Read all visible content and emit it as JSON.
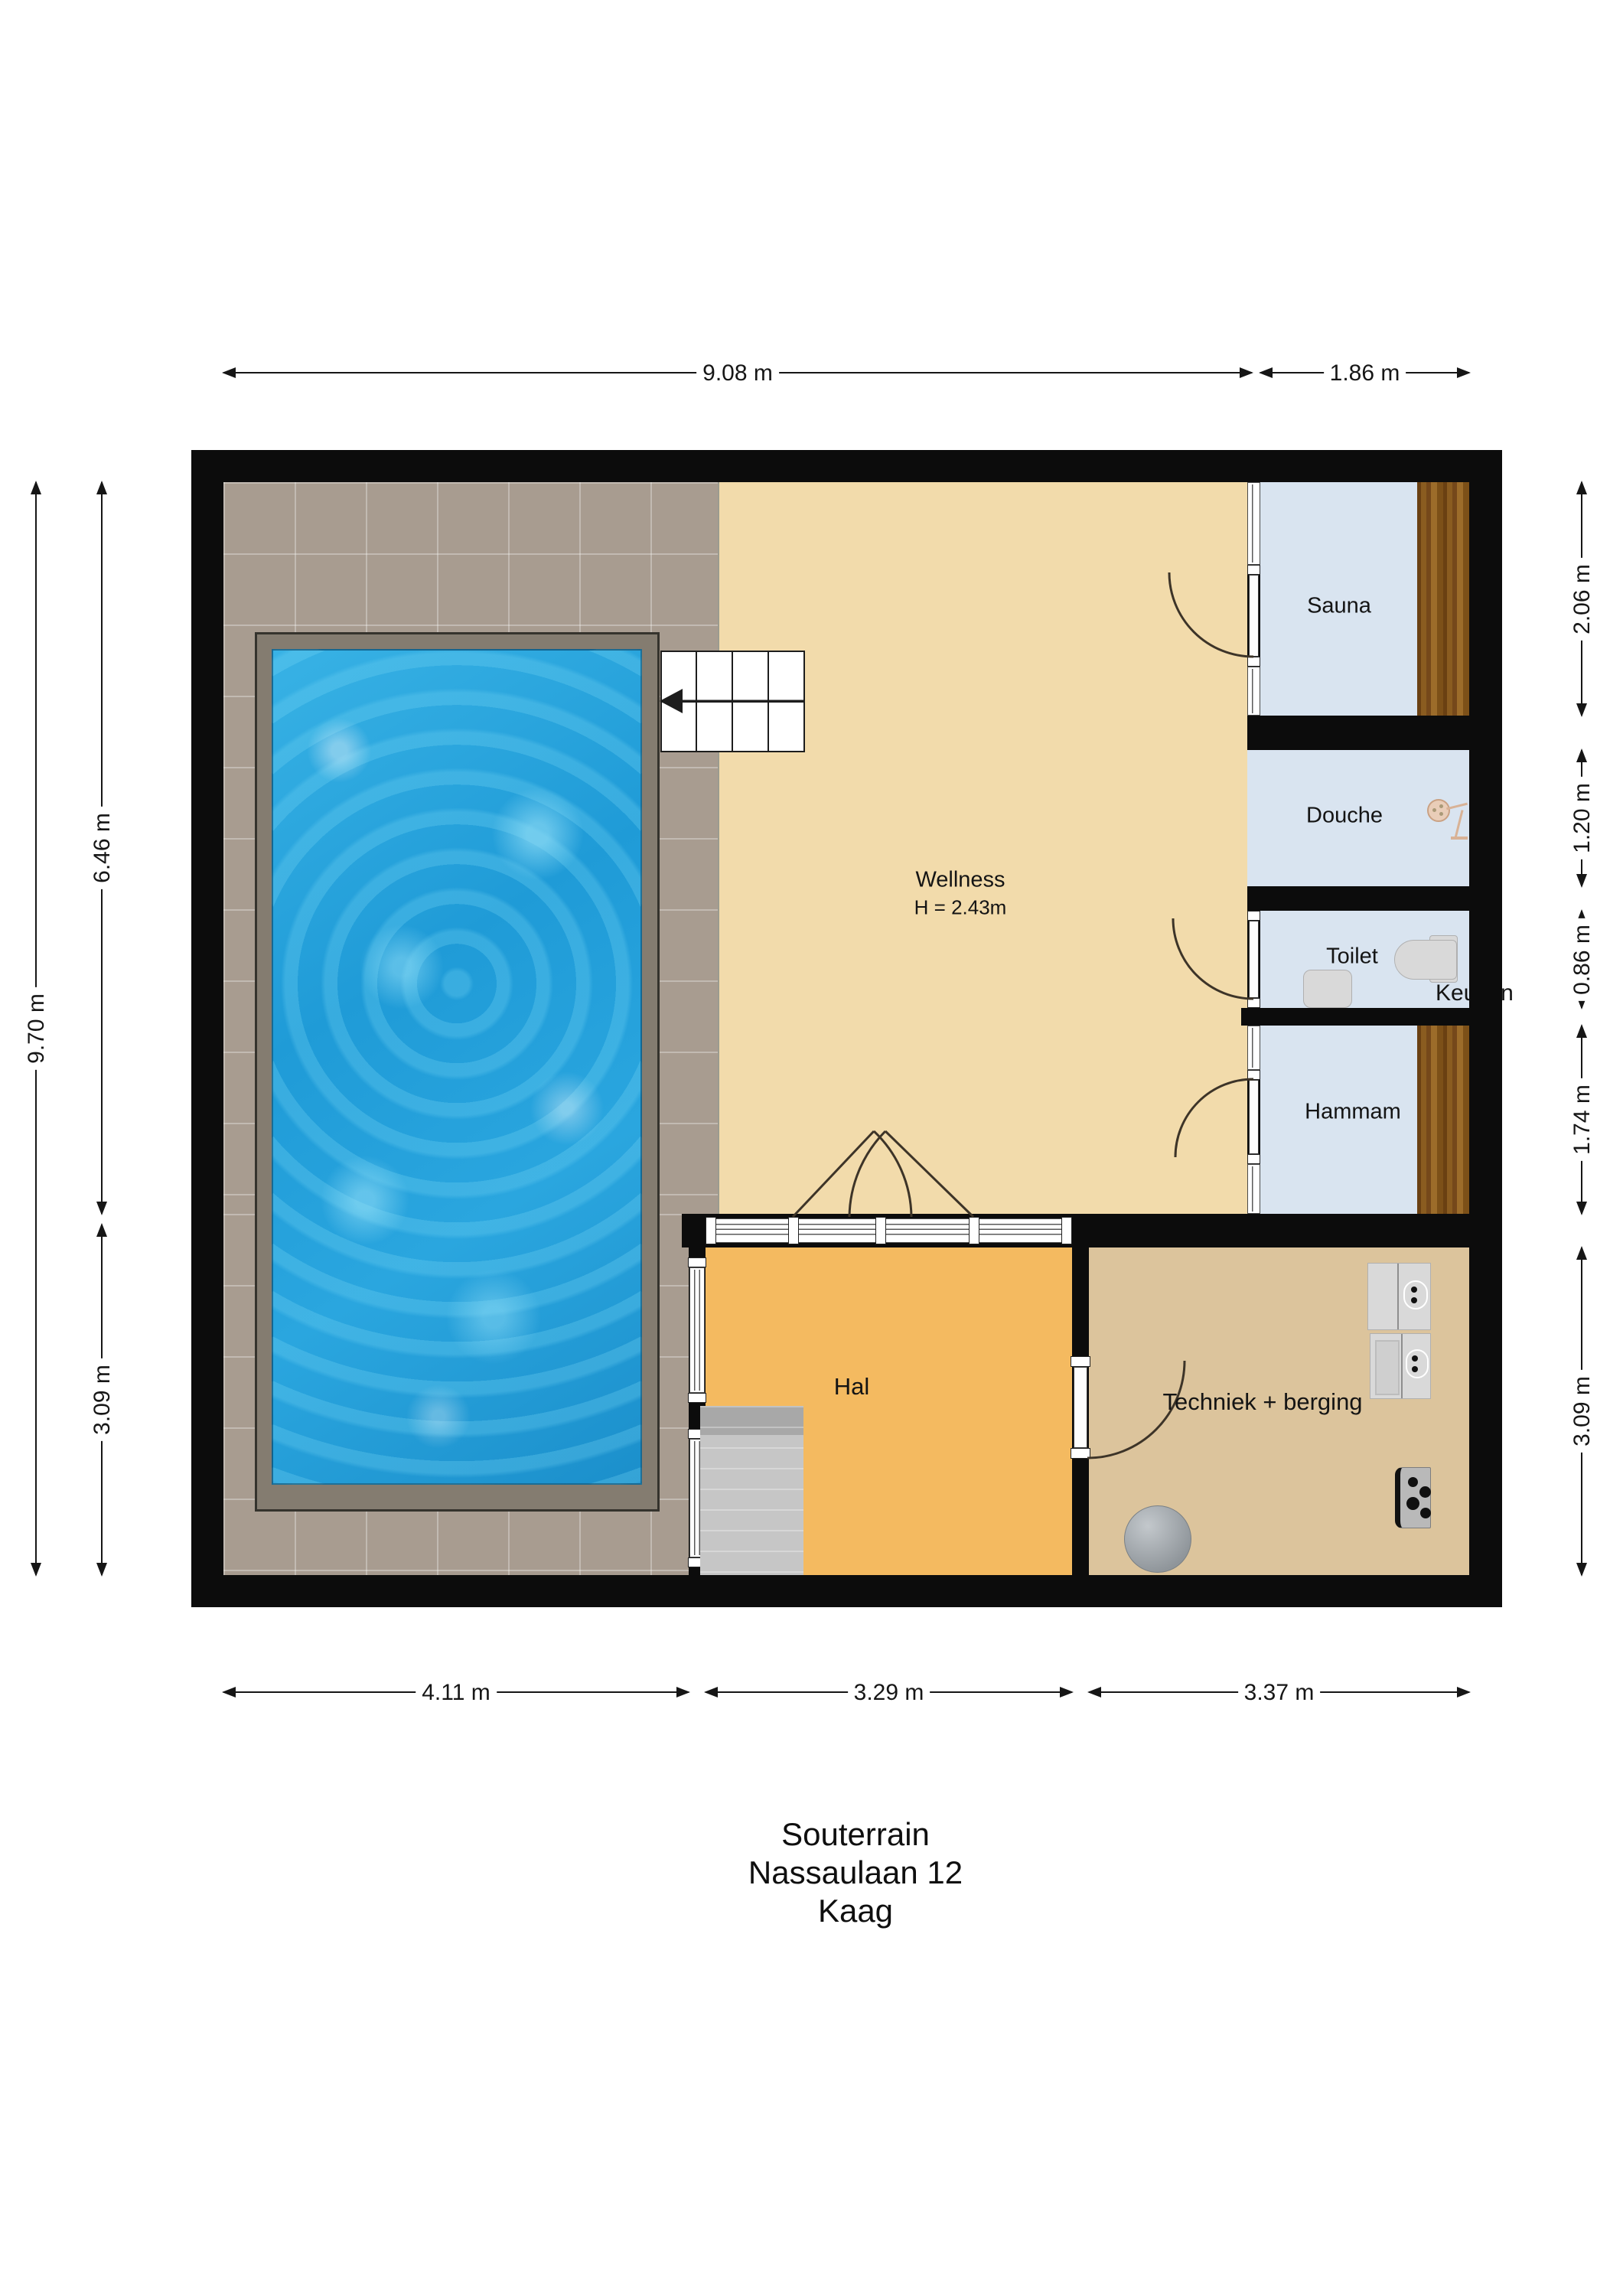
{
  "title_block": {
    "line1": "Souterrain",
    "line2": "Nassaulaan 12",
    "line3": "Kaag"
  },
  "rooms": {
    "wellness": {
      "label": "Wellness",
      "height_note": "H = 2.43m"
    },
    "sauna": {
      "label": "Sauna"
    },
    "douche": {
      "label": "Douche"
    },
    "toilet": {
      "label": "Toilet"
    },
    "hammam": {
      "label": "Hammam"
    },
    "hal": {
      "label": "Hal"
    },
    "techniek": {
      "label": "Techniek + berging"
    },
    "keuken": {
      "label": "Keuken"
    }
  },
  "dimensions": {
    "top": [
      {
        "label": "9.08 m"
      },
      {
        "label": "1.86 m"
      }
    ],
    "bottom": [
      {
        "label": "4.11 m"
      },
      {
        "label": "3.29 m"
      },
      {
        "label": "3.37 m"
      }
    ],
    "left_total": {
      "label": "9.70 m"
    },
    "left": [
      {
        "label": "6.46 m"
      },
      {
        "label": "3.09 m"
      }
    ],
    "right": [
      {
        "label": "2.06 m"
      },
      {
        "label": "1.20 m"
      },
      {
        "label": "0.86 m"
      },
      {
        "label": "1.74 m"
      },
      {
        "label": "3.09 m"
      }
    ]
  },
  "colors": {
    "wall": "#0c0c0c",
    "wellnessFloor": "#f2dbab",
    "halFloor": "#f4ba60",
    "techFloor": "#dcc49c",
    "roomBlue": "#d9e4f0",
    "tile": "#a89c90",
    "poolBorder": "#847c70",
    "water": "#1f9bd7",
    "fixture": "#d9d9d9"
  }
}
